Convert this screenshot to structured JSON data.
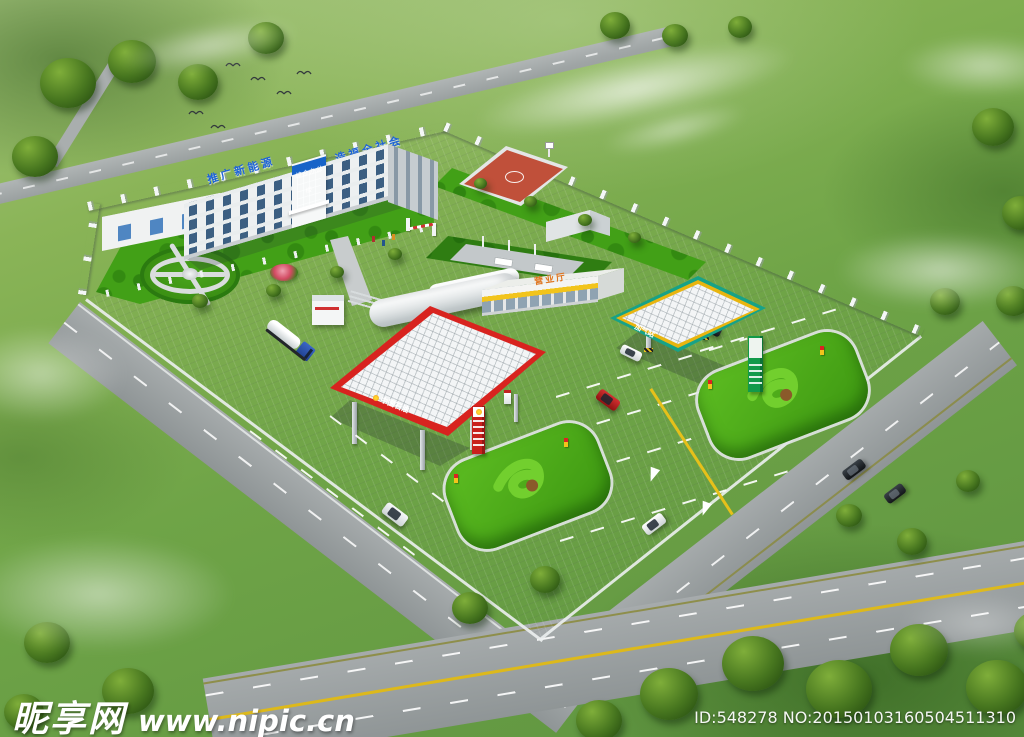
{
  "signs": {
    "office_roof_slogan_left": "推广新能源",
    "office_roof_slogan_right": "造福全社会",
    "office_entrance_sign": "综合办公楼",
    "petrol_canopy_brand": "中国石油",
    "gas_canopy_sign": "加气站",
    "service_building_sign": "营业厅"
  },
  "watermarks": {
    "site_name": "昵享网",
    "site_url": "www.nipic.cn",
    "image_id": "ID:548278 NO:20150103160504511310"
  },
  "palette": {
    "petrol_canopy_red": "#d8231f",
    "gas_canopy_teal": "#17a287",
    "basketball_court_red": "#c0503a",
    "roof_slogan_blue": "#1e63d6",
    "service_band_yellow": "#f2c41c",
    "lawn_green": "#46a81c",
    "paving_grey": "#b9bdc0",
    "road_line_yellow": "#ddb91b"
  }
}
